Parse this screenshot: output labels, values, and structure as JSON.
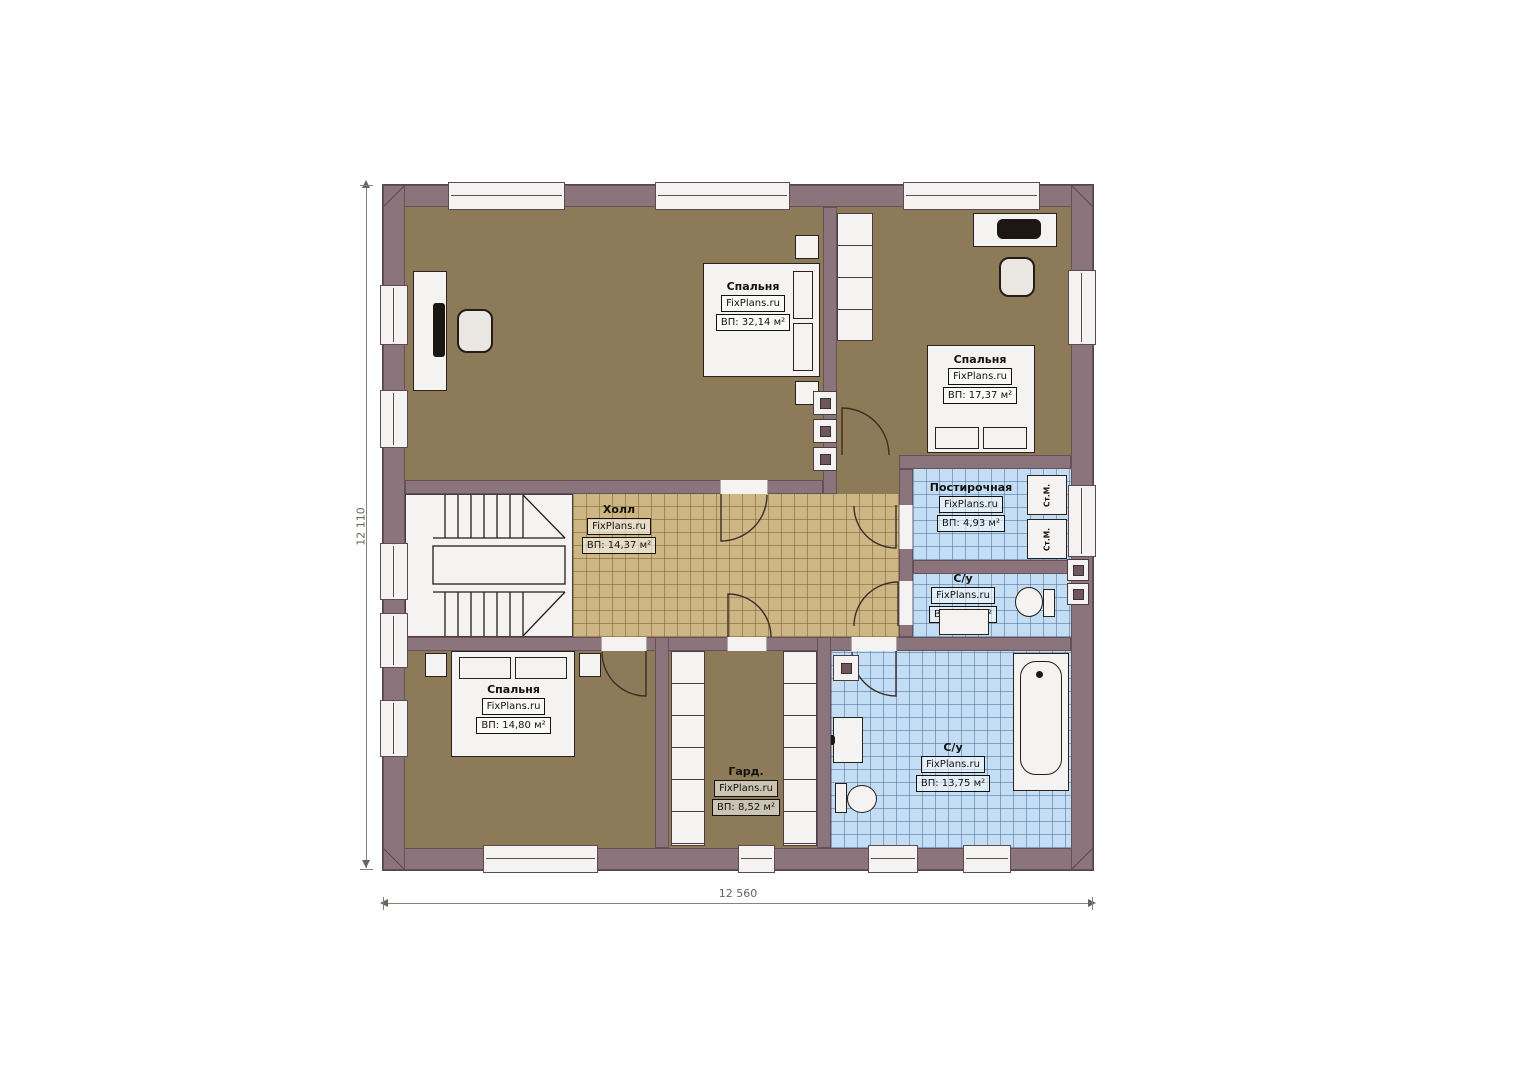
{
  "rooms": [
    {
      "name": "Спальня",
      "brand": "FixPlans.ru",
      "area": "ВП: 32,14 м²"
    },
    {
      "name": "Спальня",
      "brand": "FixPlans.ru",
      "area": "ВП: 17,37 м²"
    },
    {
      "name": "Холл",
      "brand": "FixPlans.ru",
      "area": "ВП: 14,37 м²"
    },
    {
      "name": "Постирочная",
      "brand": "FixPlans.ru",
      "area": "ВП: 4,93 м²"
    },
    {
      "name": "С/у",
      "brand": "FixPlans.ru",
      "area": "ВП: 3,12 м²"
    },
    {
      "name": "Спальня",
      "brand": "FixPlans.ru",
      "area": "ВП: 14,80 м²"
    },
    {
      "name": "Гард.",
      "brand": "FixPlans.ru",
      "area": "ВП: 8,52 м²"
    },
    {
      "name": "С/у",
      "brand": "FixPlans.ru",
      "area": "ВП: 13,75 м²"
    }
  ],
  "appliances": {
    "washer_label": "Ст.М."
  },
  "dimensions": {
    "width_label": "12 560",
    "height_label": "12 110"
  },
  "colors": {
    "wall": "#8c747c",
    "bedroom_floor": "#8c7a59",
    "hall_floor": "#cdb584",
    "wet_floor": "#c2ddf4"
  }
}
